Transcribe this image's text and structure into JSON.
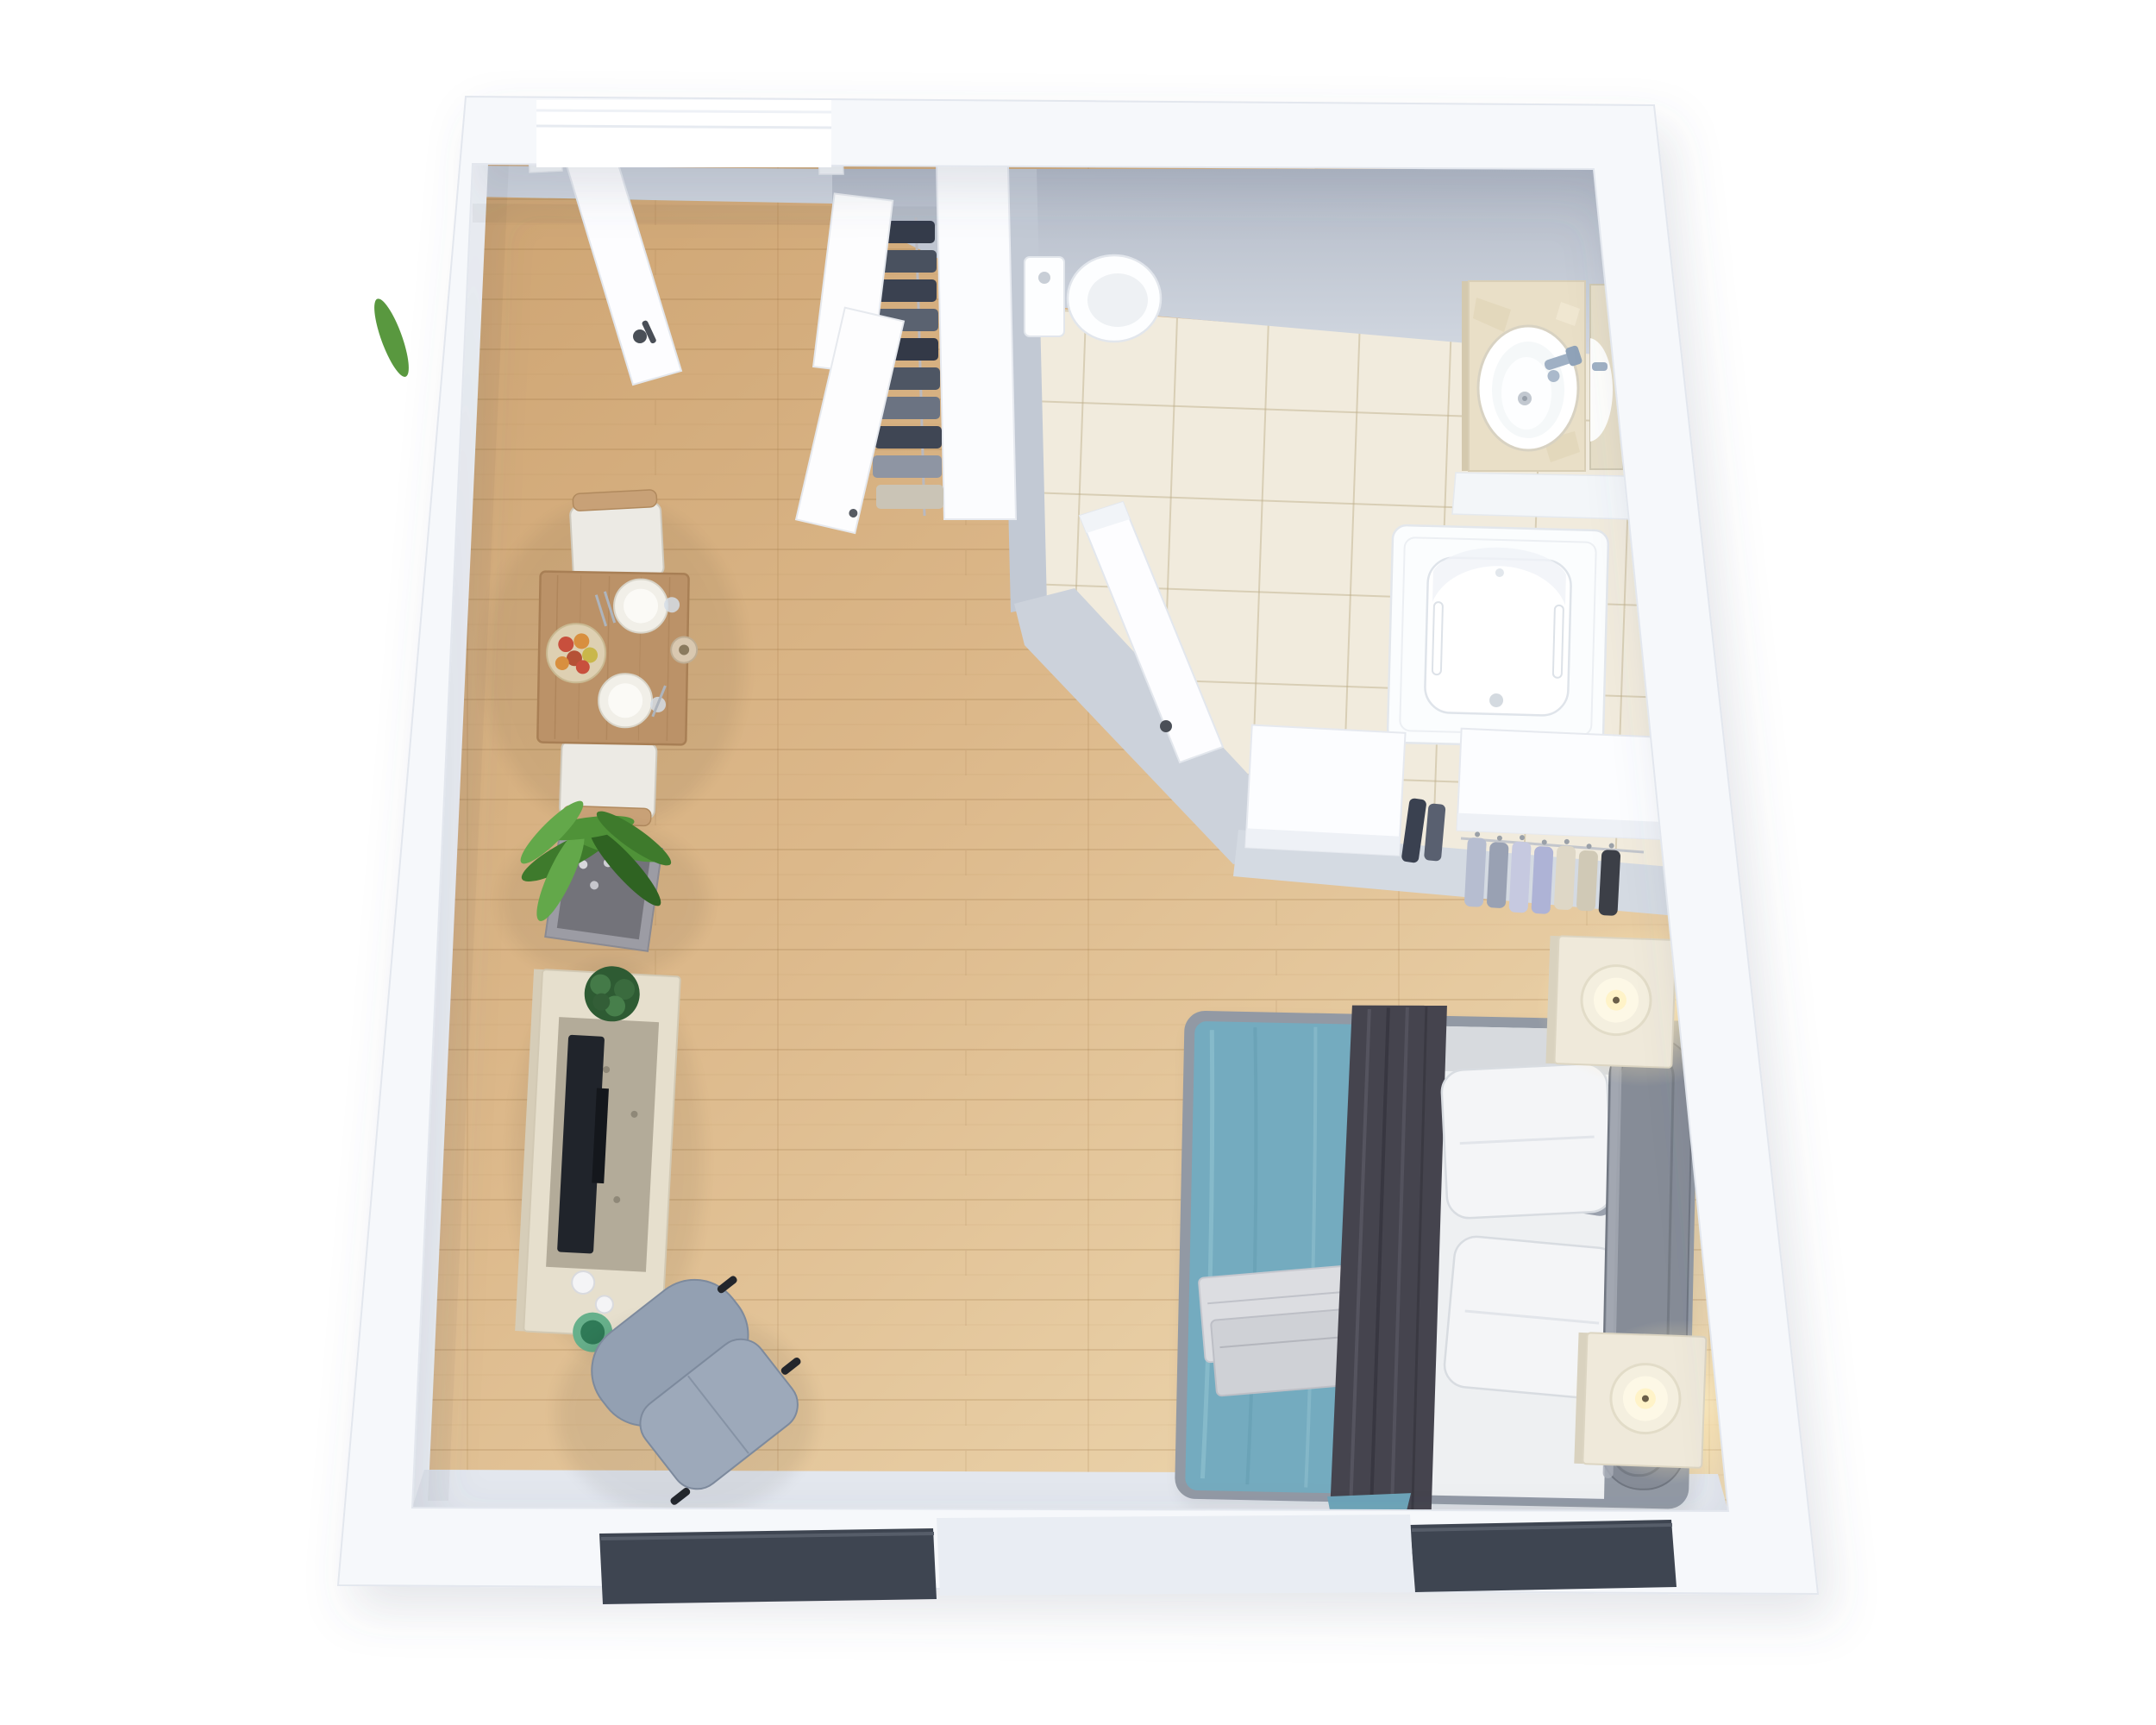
{
  "scene": {
    "description": "3D rendered top-down floor plan of a studio apartment with bathroom, walk-in closet corner, sleeping area and living/dining area",
    "view": "top-down 3D architectural render, slight keystone perspective",
    "background_color": "#ffffff"
  },
  "visible_text": [],
  "palette": {
    "wall_white": "#f6f8fb",
    "wall_edge": "#e3e7ee",
    "wall_inner_face_dark": "#b6bdc9",
    "wall_inner_face_light": "#d3d9e2",
    "wood_floor_dark": "#cfa673",
    "wood_floor_mid": "#ddba8c",
    "wood_floor_light": "#ecd6ae",
    "tile_floor": "#f1ebdd",
    "tile_grout": "#d9cdaa",
    "door_white": "#fdfdfe",
    "duvet_teal": "#74abbf",
    "throw_dark_gray": "#45444e",
    "bed_frame_gray": "#9299a4",
    "headboard_gray": "#868c97",
    "pillow_white": "#f4f5f7",
    "accent_pillow_gray": "#9aa1ad",
    "towel_gray": "#dcdde1",
    "nightstand_cream": "#efe9da",
    "candle_glow": "#ffe9b4",
    "armchair_blue_gray": "#93a0b2",
    "table_wood": "#bb9268",
    "chair_cushion": "#eceae4",
    "plant_green": "#4f9238",
    "planter_gray": "#9c9ca4",
    "console_wood": "#e6dfcd",
    "tv_black": "#20242b",
    "bowl_green": "#67b08b",
    "window_sill_dark": "#3e4551",
    "clothes_dark_navy": "#343b4a",
    "clothes_light_lavender": "#c6c9e0",
    "travertine_counter": "#e9dfc7",
    "faucet_chrome": "#9fb0c4"
  },
  "rooms": [
    {
      "name": "main-living-sleeping-area",
      "floor": "light oak wood planks"
    },
    {
      "name": "bathroom",
      "floor": "beige ceramic tile",
      "location": "top-right"
    },
    {
      "name": "entry-hall",
      "floor": "light oak wood planks",
      "location": "top-left"
    },
    {
      "name": "walk-in-closet-corner",
      "floor": "wood",
      "location": "center-right"
    }
  ],
  "fixtures_and_furniture": [
    {
      "name": "entry-door",
      "state": "open",
      "color": "#fdfdfe",
      "room": "entry-hall"
    },
    {
      "name": "hall-wardrobe",
      "contents": "dark hanging clothes",
      "doors_open": 2,
      "room": "entry-hall"
    },
    {
      "name": "toilet",
      "type": "tank toilet",
      "color": "white",
      "room": "bathroom"
    },
    {
      "name": "vanity-sink",
      "counter": "travertine",
      "sink": "round white vessel",
      "faucet": "chrome",
      "room": "bathroom"
    },
    {
      "name": "mirror",
      "location": "right wall above vanity",
      "room": "bathroom"
    },
    {
      "name": "bathtub",
      "grab_bars": 2,
      "color": "white",
      "room": "bathroom"
    },
    {
      "name": "bathroom-door",
      "state": "open",
      "room": "bathroom"
    },
    {
      "name": "closet-cabinet-left",
      "color": "white",
      "room": "walk-in-closet-corner"
    },
    {
      "name": "closet-cabinet-right",
      "color": "white",
      "room": "walk-in-closet-corner"
    },
    {
      "name": "hanging-clothes-light",
      "count": 7,
      "colors": [
        "plaid",
        "gray",
        "lavender",
        "cream",
        "houndstooth"
      ],
      "room": "walk-in-closet-corner"
    },
    {
      "name": "double-bed",
      "duvet": "teal",
      "throw": "dark gray",
      "pillows_white": 2,
      "pillows_gray": 2,
      "towels_folded": 2,
      "headboard": "gray upholstered",
      "room": "main-living-sleeping-area"
    },
    {
      "name": "nightstand-top",
      "candle": "lit",
      "color": "cream",
      "room": "main-living-sleeping-area"
    },
    {
      "name": "nightstand-bottom",
      "candle": "lit",
      "color": "cream",
      "room": "main-living-sleeping-area"
    },
    {
      "name": "dining-table",
      "settings": 2,
      "items": [
        "fruit plate",
        "candle",
        "glasses",
        "cutlery"
      ],
      "room": "main-living-sleeping-area"
    },
    {
      "name": "dining-chairs",
      "count": 2,
      "cushion": "white",
      "frame": "wood",
      "room": "main-living-sleeping-area"
    },
    {
      "name": "potted-plant",
      "size": "large",
      "room": "main-living-sleeping-area"
    },
    {
      "name": "tv-console",
      "items": [
        "flat tv",
        "small plant",
        "cups",
        "green bowl"
      ],
      "room": "main-living-sleeping-area"
    },
    {
      "name": "armchair-with-ottoman",
      "color": "blue-gray",
      "room": "main-living-sleeping-area"
    },
    {
      "name": "window-sills",
      "count": 2,
      "color": "dark gray",
      "location": "bottom wall"
    }
  ],
  "counts": {
    "doors": 3,
    "chairs": 2,
    "bed_pillows": 4,
    "bedside_candles": 2,
    "windows": 2,
    "sinks": 1,
    "clothes_groups": 2
  }
}
